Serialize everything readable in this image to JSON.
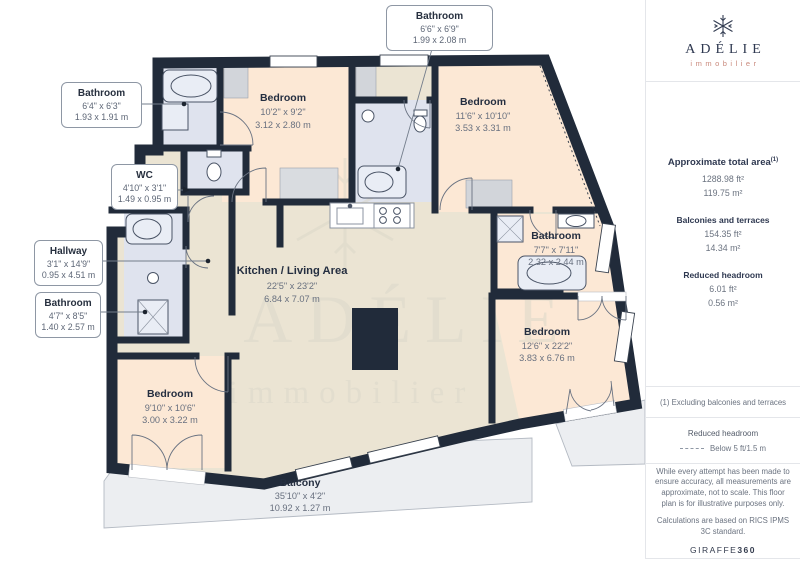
{
  "colors": {
    "wall": "#212b3a",
    "bathroom_floor": "#dfe3ee",
    "bedroom_floor": "#fce8d5",
    "living_floor": "#ebe4d3",
    "balcony_floor": "#eceef1",
    "brand_navy": "#2e3850",
    "brand_salmon": "#c9897c"
  },
  "logo": {
    "brand": "ADÉLIE",
    "subtitle": "immobilier"
  },
  "watermark": {
    "brand": "ADÉLIE",
    "subtitle": "immobilier"
  },
  "rooms": {
    "bedroom_top": {
      "name": "Bedroom",
      "imperial": "10'2\" x 9'2\"",
      "metric": "3.12 x 2.80 m"
    },
    "bedroom_top_right": {
      "name": "Bedroom",
      "imperial": "11'6\" x 10'10\"",
      "metric": "3.53 x 3.31 m"
    },
    "kitchen_living": {
      "name": "Kitchen / Living Area",
      "imperial": "22'5\" x 23'2\"",
      "metric": "6.84 x 7.07 m"
    },
    "bathroom_right": {
      "name": "Bathroom",
      "imperial": "7'7\" x 7'11\"",
      "metric": "2.32 x 2.44 m"
    },
    "bedroom_bottom_right": {
      "name": "Bedroom",
      "imperial": "12'6\" x 22'2\"",
      "metric": "3.83 x 6.76 m"
    },
    "bedroom_bottom_left": {
      "name": "Bedroom",
      "imperial": "9'10\" x 10'6\"",
      "metric": "3.00 x 3.22 m"
    },
    "balcony": {
      "name": "Balcony",
      "imperial": "35'10\" x 4'2\"",
      "metric": "10.92 x 1.27 m"
    }
  },
  "callouts": {
    "bathroom_top_left": {
      "name": "Bathroom",
      "imperial": "6'4\" x 6'3\"",
      "metric": "1.93 x 1.91 m"
    },
    "bathroom_top": {
      "name": "Bathroom",
      "imperial": "6'6\" x 6'9\"",
      "metric": "1.99 x 2.08 m"
    },
    "wc": {
      "name": "WC",
      "imperial": "4'10\" x 3'1\"",
      "metric": "1.49 x 0.95 m"
    },
    "hallway": {
      "name": "Hallway",
      "imperial": "3'1\" x 14'9\"",
      "metric": "0.95 x 4.51 m"
    },
    "bathroom_mid_left": {
      "name": "Bathroom",
      "imperial": "4'7\" x 8'5\"",
      "metric": "1.40 x 2.57 m"
    }
  },
  "sidebar": {
    "total": {
      "label": "Approximate total area",
      "footnote_marker": "(1)",
      "imperial": "1288.98 ft²",
      "metric": "119.75 m²"
    },
    "balconies": {
      "label": "Balconies and terraces",
      "imperial": "154.35 ft²",
      "metric": "14.34 m²"
    },
    "reduced": {
      "label": "Reduced headroom",
      "imperial": "6.01 ft²",
      "metric": "0.56 m²"
    },
    "footnote": "(1) Excluding balconies and terraces",
    "legend": {
      "title": "Reduced headroom",
      "item": "Below 5 ft/1.5 m"
    },
    "disclaimer": "While every attempt has been made to ensure accuracy, all measurements are approximate, not to scale. This floor plan is for illustrative purposes only.",
    "standard": "Calculations are based on RICS IPMS 3C standard.",
    "credit": {
      "brand": "GIRAFFE",
      "suffix": "360"
    }
  }
}
